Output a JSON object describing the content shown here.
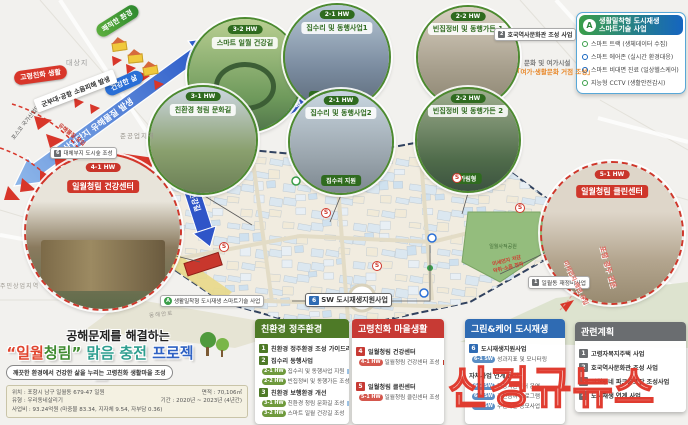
{
  "watermark": "신경규뉴스",
  "markers": {
    "s": "S"
  },
  "top_left": {
    "arrow_label": "산업단지 유해물질 발생",
    "elderly_chip": "고령친화 생활",
    "env_chip": "쾌적한 환경",
    "health_chip": "건강한 삶",
    "noise_banner": "군부대·공항 소음피해 발생",
    "site_label": "대상지",
    "posco_label": "포스코 국가산업단지",
    "hazard_label": "유해물질 유입",
    "forest_chip": "6",
    "forest_label": "대체부지 도시숲 조성"
  },
  "circles": [
    {
      "chip": "3-2 HW",
      "title": "스마트 일월 건강길",
      "sub": ""
    },
    {
      "chip": "3-1 HW",
      "title": "친환경 청림 문화길",
      "sub": ""
    },
    {
      "chip": "2-1 HW",
      "title": "집수리 및 동행사업1",
      "sub": "골목연계 동행사업"
    },
    {
      "chip": "2-1 HW",
      "title": "집수리 및 동행사업2",
      "sub": "집수리 지원"
    },
    {
      "chip": "2-2 HW",
      "title": "빈집정비 및 동행가든 1",
      "sub": "철거형"
    },
    {
      "chip": "2-2 HW",
      "title": "빈집정비 및 동행가든 2",
      "sub": "가림형"
    },
    {
      "chip": "4-1 HW",
      "title": "일월청림 건강센터",
      "sub": ""
    },
    {
      "chip": "5-1 HW",
      "title": "일월청림 클린센터",
      "sub": ""
    }
  ],
  "smart_panel": {
    "badge": "A",
    "title1": "생활밀착형 도시재생",
    "title2": "스마트기술 사업",
    "items": [
      "스마트 트랙 (생체데이터 수집)",
      "스마트 에어존 (실시간 환경대응)",
      "스마트 비대면 진료 (일상헬스케어)",
      "지능형 CCTV (생활안전감시)"
    ]
  },
  "map": {
    "heritage_chip": "2",
    "heritage_label": "호국역사문화관 조성 사업",
    "leisure_line1": "문화 및 여가시설",
    "leisure_line2": "「여가·생활문화 거점 조성」",
    "smart_tag_chip": "A",
    "smart_tag": "생활밀착형 도시재생 스마트기술 사업",
    "sw_tag_chip": "6",
    "sw_tag": "SW 도시재생지원사업",
    "road_label": "동해안로",
    "zone_left": "주민상업지역",
    "zone_top": "준공업지역",
    "arrow_road_label": "스마트 일월 건강길",
    "park_label": "일월사적공원",
    "redevelop_chip": "1",
    "redevelop_label": "일월동 재정비사업",
    "gateway_label": "포항 경주 관문",
    "inflow_label": "미세먼지·매연 유입",
    "spread_line1": "미세먼지 저감",
    "spread_line2": "악취·소음 전파",
    "bottom_arrow_label": "한울공원 진입도로 조성"
  },
  "title_block": {
    "line1": "공해문제를 해결하는",
    "t1": "“일월",
    "t2": "청림”",
    "t3": " 맑음 충전 ",
    "t4": "프로젝트",
    "subtitle": "깨끗한 환경에서 건강한 삶을 누리는 고령친화 생활마을 조성",
    "details": [
      "위치 : 포항시 남구 일월동 679-47 일원",
      "면적 : 70,106㎡",
      "유형 : 우리동네살리기",
      "기간 : 2020년 ~ 2023년 (4년간)",
      "사업비 : 93.24억원 (마중물 83.34, 지자체 9.54, 자부담 0.36)"
    ]
  },
  "panels": [
    {
      "title": "친환경 정주환경",
      "groups": [
        {
          "num": "1",
          "head": "친환경 정주환경 조성 가이드라인"
        },
        {
          "num": "2",
          "head": "집수리 동행사업",
          "subs": [
            {
              "chip": "2-1 HW",
              "label": "집수리 및 동행사업 지원"
            },
            {
              "chip": "2-2 HW",
              "label": "빈집정비 및 동행가든 조성"
            }
          ]
        },
        {
          "num": "3",
          "head": "친환경 보행환경 개선",
          "subs": [
            {
              "chip": "3-1 HW",
              "label": "친환경 청림 문화길 조성"
            },
            {
              "chip": "3-2 HW",
              "label": "스마트 일월 건강길 조성"
            }
          ]
        }
      ]
    },
    {
      "title": "고령친화 마을생활",
      "groups": [
        {
          "num": "4",
          "head": "일월청림 건강센터",
          "subs": [
            {
              "chip": "4-1 HW",
              "label": "일월청림 건강센터 조성"
            }
          ]
        },
        {
          "num": "5",
          "head": "일월청림 클린센터",
          "subs": [
            {
              "chip": "5-1 HW",
              "label": "일월청림 클린센터 조성"
            }
          ]
        }
      ]
    },
    {
      "title": "그린&케어 도시재생",
      "groups": [
        {
          "num": "6",
          "head": "도시재생지원사업",
          "subs": [
            {
              "chip": "6-1 SW",
              "label": "성과지표 및 모니터링"
            }
          ]
        },
        {
          "num": "",
          "head": "자체사업 연계 운영",
          "subs": [
            {
              "chip": "6-2 SW",
              "label": "현장지원센터 운영"
            },
            {
              "chip": "6-3 SW",
              "label": "주민참여 프로그램"
            },
            {
              "chip": "6-4 SW",
              "label": "주민제안 공모사업"
            }
          ]
        }
      ]
    },
    {
      "title": "관련계획",
      "groups": [
        {
          "num": "1",
          "head": "고령자복지주택 사업"
        },
        {
          "num": "2",
          "head": "호국역사문화관 조성 사업"
        },
        {
          "num": "3",
          "head": "일월동네 파크골프장 조성사업"
        },
        {
          "num": "4",
          "head": "도시재생 연계 사업"
        }
      ]
    }
  ]
}
